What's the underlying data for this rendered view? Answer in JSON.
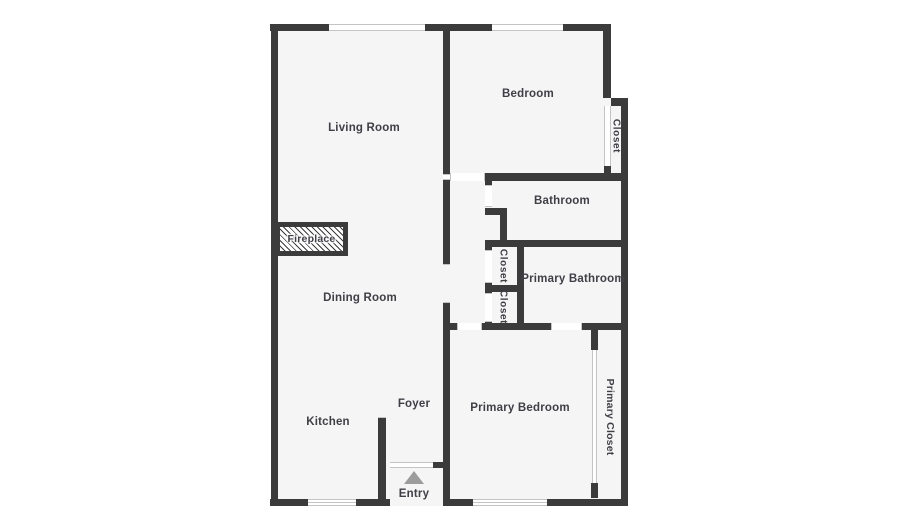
{
  "plan": {
    "type": "residential-floor-plan",
    "background_color": "#ffffff",
    "floor_color": "#f5f5f5",
    "wall_color": "#3b3b3b",
    "label_color": "#3f3f46",
    "window_line_color": "#c4c4c4",
    "entry_arrow_color": "#9c9c9c"
  },
  "rooms": [
    {
      "label": "Living Room"
    },
    {
      "label": "Bedroom"
    },
    {
      "label": "Closet"
    },
    {
      "label": "Bathroom"
    },
    {
      "label": "Closet"
    },
    {
      "label": "Closet"
    },
    {
      "label": "Primary Bathroom"
    },
    {
      "label": "Dining Room"
    },
    {
      "label": "Fireplace"
    },
    {
      "label": "Kitchen"
    },
    {
      "label": "Foyer"
    },
    {
      "label": "Entry"
    },
    {
      "label": "Primary Bedroom"
    },
    {
      "label": "Primary Closet"
    }
  ]
}
